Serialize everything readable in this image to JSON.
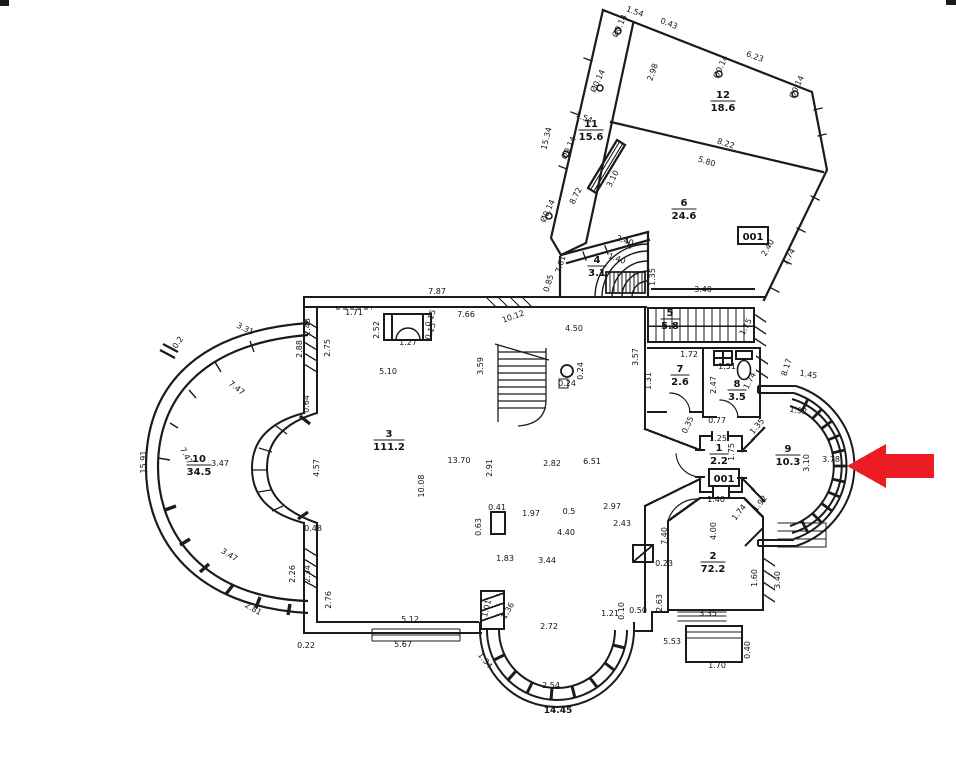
{
  "plan": {
    "description": "scanned floor plan with red marker arrow",
    "total_width_label": "14.45"
  },
  "arrow": {
    "color": "#ec1c24"
  },
  "rooms": [
    {
      "number": "12",
      "area": "18.6",
      "x": 723,
      "y": 98
    },
    {
      "number": "11",
      "area": "15.6",
      "x": 591,
      "y": 127
    },
    {
      "number": "6",
      "area": "24.6",
      "x": 684,
      "y": 206
    },
    {
      "number": "4",
      "area": "3.1",
      "x": 597,
      "y": 263
    },
    {
      "number": "5",
      "area": "5.8",
      "x": 670,
      "y": 316
    },
    {
      "number": "7",
      "area": "2.6",
      "x": 680,
      "y": 372
    },
    {
      "number": "8",
      "area": "3.5",
      "x": 737,
      "y": 387
    },
    {
      "number": "1",
      "area": "2.2",
      "x": 719,
      "y": 451
    },
    {
      "number": "9",
      "area": "10.3",
      "x": 788,
      "y": 452
    },
    {
      "number": "3",
      "area": "111.2",
      "x": 389,
      "y": 437
    },
    {
      "number": "10",
      "area": "34.5",
      "x": 199,
      "y": 462
    },
    {
      "number": "2",
      "area": "72.2",
      "x": 713,
      "y": 559
    }
  ],
  "unit_labels": [
    {
      "text": "001",
      "x": 753,
      "y": 236
    },
    {
      "text": "001",
      "x": 724,
      "y": 478
    }
  ],
  "dimensions": [
    {
      "t": "1.54",
      "x": 634,
      "y": 14,
      "r": 20
    },
    {
      "t": "0.43",
      "x": 668,
      "y": 26,
      "r": 22
    },
    {
      "t": "6.23",
      "x": 754,
      "y": 59,
      "r": 20
    },
    {
      "t": "Ø0.14",
      "x": 622,
      "y": 27,
      "r": -65
    },
    {
      "t": "Ø0.14",
      "x": 600,
      "y": 82,
      "r": -65
    },
    {
      "t": "Ø0.14",
      "x": 723,
      "y": 68,
      "r": -65
    },
    {
      "t": "Ø0.14",
      "x": 799,
      "y": 88,
      "r": -65
    },
    {
      "t": "Ø0.14",
      "x": 571,
      "y": 149,
      "r": -65
    },
    {
      "t": "Ø0.14",
      "x": 550,
      "y": 212,
      "r": -65
    },
    {
      "t": "2.98",
      "x": 655,
      "y": 73,
      "r": -70
    },
    {
      "t": "8.22",
      "x": 725,
      "y": 146,
      "r": 18
    },
    {
      "t": "5.80",
      "x": 706,
      "y": 164,
      "r": 18
    },
    {
      "t": "15.34",
      "x": 549,
      "y": 139,
      "r": -76
    },
    {
      "t": "7.54",
      "x": 583,
      "y": 120,
      "r": 22
    },
    {
      "t": "8.72",
      "x": 578,
      "y": 197,
      "r": -63
    },
    {
      "t": "3.10",
      "x": 615,
      "y": 180,
      "r": -63
    },
    {
      "t": "2.40",
      "x": 624,
      "y": 243,
      "r": 20
    },
    {
      "t": "1.40",
      "x": 616,
      "y": 261,
      "r": 20
    },
    {
      "t": "7.61",
      "x": 563,
      "y": 265,
      "r": -73
    },
    {
      "t": "0.85",
      "x": 551,
      "y": 284,
      "r": -73
    },
    {
      "t": "2.40",
      "x": 770,
      "y": 249,
      "r": -60
    },
    {
      "t": "1.74",
      "x": 791,
      "y": 258,
      "r": -60
    },
    {
      "t": "3.40",
      "x": 703,
      "y": 292,
      "r": 0
    },
    {
      "t": "1.35",
      "x": 655,
      "y": 277,
      "r": -90
    },
    {
      "t": "7.87",
      "x": 437,
      "y": 294,
      "r": 0
    },
    {
      "t": "1.71",
      "x": 354,
      "y": 315,
      "r": 0
    },
    {
      "t": "1.27",
      "x": 408,
      "y": 345,
      "r": 0
    },
    {
      "t": "0.15",
      "x": 433,
      "y": 319,
      "r": -70
    },
    {
      "t": "0.15",
      "x": 433,
      "y": 332,
      "r": -70
    },
    {
      "t": "2.52",
      "x": 379,
      "y": 330,
      "r": -90
    },
    {
      "t": "7.66",
      "x": 466,
      "y": 317,
      "r": 0
    },
    {
      "t": "10.12",
      "x": 514,
      "y": 319,
      "r": -20
    },
    {
      "t": "4.50",
      "x": 574,
      "y": 331,
      "r": 0
    },
    {
      "t": "5.10",
      "x": 388,
      "y": 374,
      "r": 0
    },
    {
      "t": "3.59",
      "x": 483,
      "y": 366,
      "r": -90
    },
    {
      "t": "3.57",
      "x": 638,
      "y": 357,
      "r": -90
    },
    {
      "t": "2.43",
      "x": 310,
      "y": 327,
      "r": -90
    },
    {
      "t": "2.75",
      "x": 330,
      "y": 348,
      "r": -90
    },
    {
      "t": "0.64",
      "x": 309,
      "y": 404,
      "r": -90
    },
    {
      "t": "0.24",
      "x": 567,
      "y": 386,
      "r": 0
    },
    {
      "t": "0.24",
      "x": 583,
      "y": 371,
      "r": -90
    },
    {
      "t": "1.72",
      "x": 689,
      "y": 357,
      "r": 0
    },
    {
      "t": "1.31",
      "x": 651,
      "y": 381,
      "r": -90
    },
    {
      "t": "1.51",
      "x": 727,
      "y": 369,
      "r": 0
    },
    {
      "t": "2.47",
      "x": 716,
      "y": 385,
      "r": -90
    },
    {
      "t": "1.74",
      "x": 752,
      "y": 382,
      "r": -62
    },
    {
      "t": "1.15",
      "x": 748,
      "y": 328,
      "r": -62
    },
    {
      "t": "8.17",
      "x": 789,
      "y": 368,
      "r": -72
    },
    {
      "t": "1.25",
      "x": 718,
      "y": 441,
      "r": 0
    },
    {
      "t": "1.75",
      "x": 734,
      "y": 452,
      "r": -90
    },
    {
      "t": "0.77",
      "x": 717,
      "y": 423,
      "r": 0
    },
    {
      "t": "0.35",
      "x": 690,
      "y": 426,
      "r": -65
    },
    {
      "t": "1.35",
      "x": 759,
      "y": 428,
      "r": -50
    },
    {
      "t": "1.45",
      "x": 808,
      "y": 377,
      "r": 10
    },
    {
      "t": "1.92",
      "x": 798,
      "y": 413,
      "r": 8
    },
    {
      "t": "3.10",
      "x": 809,
      "y": 463,
      "r": -90
    },
    {
      "t": "3.78",
      "x": 831,
      "y": 462,
      "r": 0
    },
    {
      "t": "1.92",
      "x": 762,
      "y": 505,
      "r": -52
    },
    {
      "t": "1.74",
      "x": 741,
      "y": 514,
      "r": -52
    },
    {
      "t": "1.40",
      "x": 716,
      "y": 502,
      "r": 0
    },
    {
      "t": "7.40",
      "x": 667,
      "y": 536,
      "r": -90
    },
    {
      "t": "4.00",
      "x": 716,
      "y": 531,
      "r": -90
    },
    {
      "t": "0.23",
      "x": 664,
      "y": 566,
      "r": 0
    },
    {
      "t": "2.63",
      "x": 662,
      "y": 603,
      "r": -90
    },
    {
      "t": "3.35",
      "x": 708,
      "y": 616,
      "r": 0
    },
    {
      "t": "1.60",
      "x": 757,
      "y": 578,
      "r": -90
    },
    {
      "t": "3.40",
      "x": 780,
      "y": 580,
      "r": -90
    },
    {
      "t": "5.53",
      "x": 672,
      "y": 644,
      "r": 0
    },
    {
      "t": "1.70",
      "x": 717,
      "y": 668,
      "r": 0
    },
    {
      "t": "0.40",
      "x": 750,
      "y": 650,
      "r": -90
    },
    {
      "t": "1.21",
      "x": 610,
      "y": 616,
      "r": 0
    },
    {
      "t": "0.10",
      "x": 624,
      "y": 611,
      "r": -90
    },
    {
      "t": "0.50",
      "x": 638,
      "y": 613,
      "r": 0
    },
    {
      "t": "2.72",
      "x": 549,
      "y": 629,
      "r": 0
    },
    {
      "t": "2.54",
      "x": 551,
      "y": 688,
      "r": 0
    },
    {
      "t": "1.34",
      "x": 483,
      "y": 662,
      "r": 52
    },
    {
      "t": "1.01",
      "x": 489,
      "y": 609,
      "r": -76
    },
    {
      "t": "1.36",
      "x": 510,
      "y": 612,
      "r": -60
    },
    {
      "t": "5.12",
      "x": 410,
      "y": 622,
      "r": 0
    },
    {
      "t": "5.67",
      "x": 403,
      "y": 647,
      "r": 0
    },
    {
      "t": "0.22",
      "x": 306,
      "y": 648,
      "r": 0
    },
    {
      "t": "2.81",
      "x": 252,
      "y": 611,
      "r": 30
    },
    {
      "t": "2.76",
      "x": 331,
      "y": 600,
      "r": -90
    },
    {
      "t": "2.26",
      "x": 295,
      "y": 574,
      "r": -90
    },
    {
      "t": "2.34",
      "x": 310,
      "y": 574,
      "r": -90
    },
    {
      "t": "0.48",
      "x": 313,
      "y": 531,
      "r": 0
    },
    {
      "t": "3.47",
      "x": 228,
      "y": 557,
      "r": 32
    },
    {
      "t": "7.47",
      "x": 235,
      "y": 390,
      "r": 38
    },
    {
      "t": "7.47",
      "x": 184,
      "y": 457,
      "r": 62
    },
    {
      "t": "3.31",
      "x": 244,
      "y": 331,
      "r": 26
    },
    {
      "t": "0.2",
      "x": 180,
      "y": 344,
      "r": -55
    },
    {
      "t": "2.88",
      "x": 302,
      "y": 349,
      "r": -90
    },
    {
      "t": "15.91",
      "x": 146,
      "y": 462,
      "r": -90
    },
    {
      "t": "3.47",
      "x": 220,
      "y": 466,
      "r": 0
    },
    {
      "t": "4.57",
      "x": 319,
      "y": 468,
      "r": -90
    },
    {
      "t": "13.70",
      "x": 459,
      "y": 463,
      "r": 0
    },
    {
      "t": "10.08",
      "x": 424,
      "y": 486,
      "r": -90
    },
    {
      "t": "2.91",
      "x": 492,
      "y": 468,
      "r": -90
    },
    {
      "t": "6.51",
      "x": 592,
      "y": 464,
      "r": 0
    },
    {
      "t": "2.82",
      "x": 552,
      "y": 466,
      "r": 0
    },
    {
      "t": "0.41",
      "x": 497,
      "y": 510,
      "r": 0
    },
    {
      "t": "0.63",
      "x": 481,
      "y": 527,
      "r": -90
    },
    {
      "t": "1.97",
      "x": 531,
      "y": 516,
      "r": 0
    },
    {
      "t": "0.5",
      "x": 569,
      "y": 514,
      "r": 0
    },
    {
      "t": "2.97",
      "x": 612,
      "y": 509,
      "r": 0
    },
    {
      "t": "2.43",
      "x": 622,
      "y": 526,
      "r": 0
    },
    {
      "t": "4.40",
      "x": 566,
      "y": 535,
      "r": 0
    },
    {
      "t": "3.44",
      "x": 547,
      "y": 563,
      "r": 0
    },
    {
      "t": "1.83",
      "x": 505,
      "y": 561,
      "r": 0
    }
  ]
}
